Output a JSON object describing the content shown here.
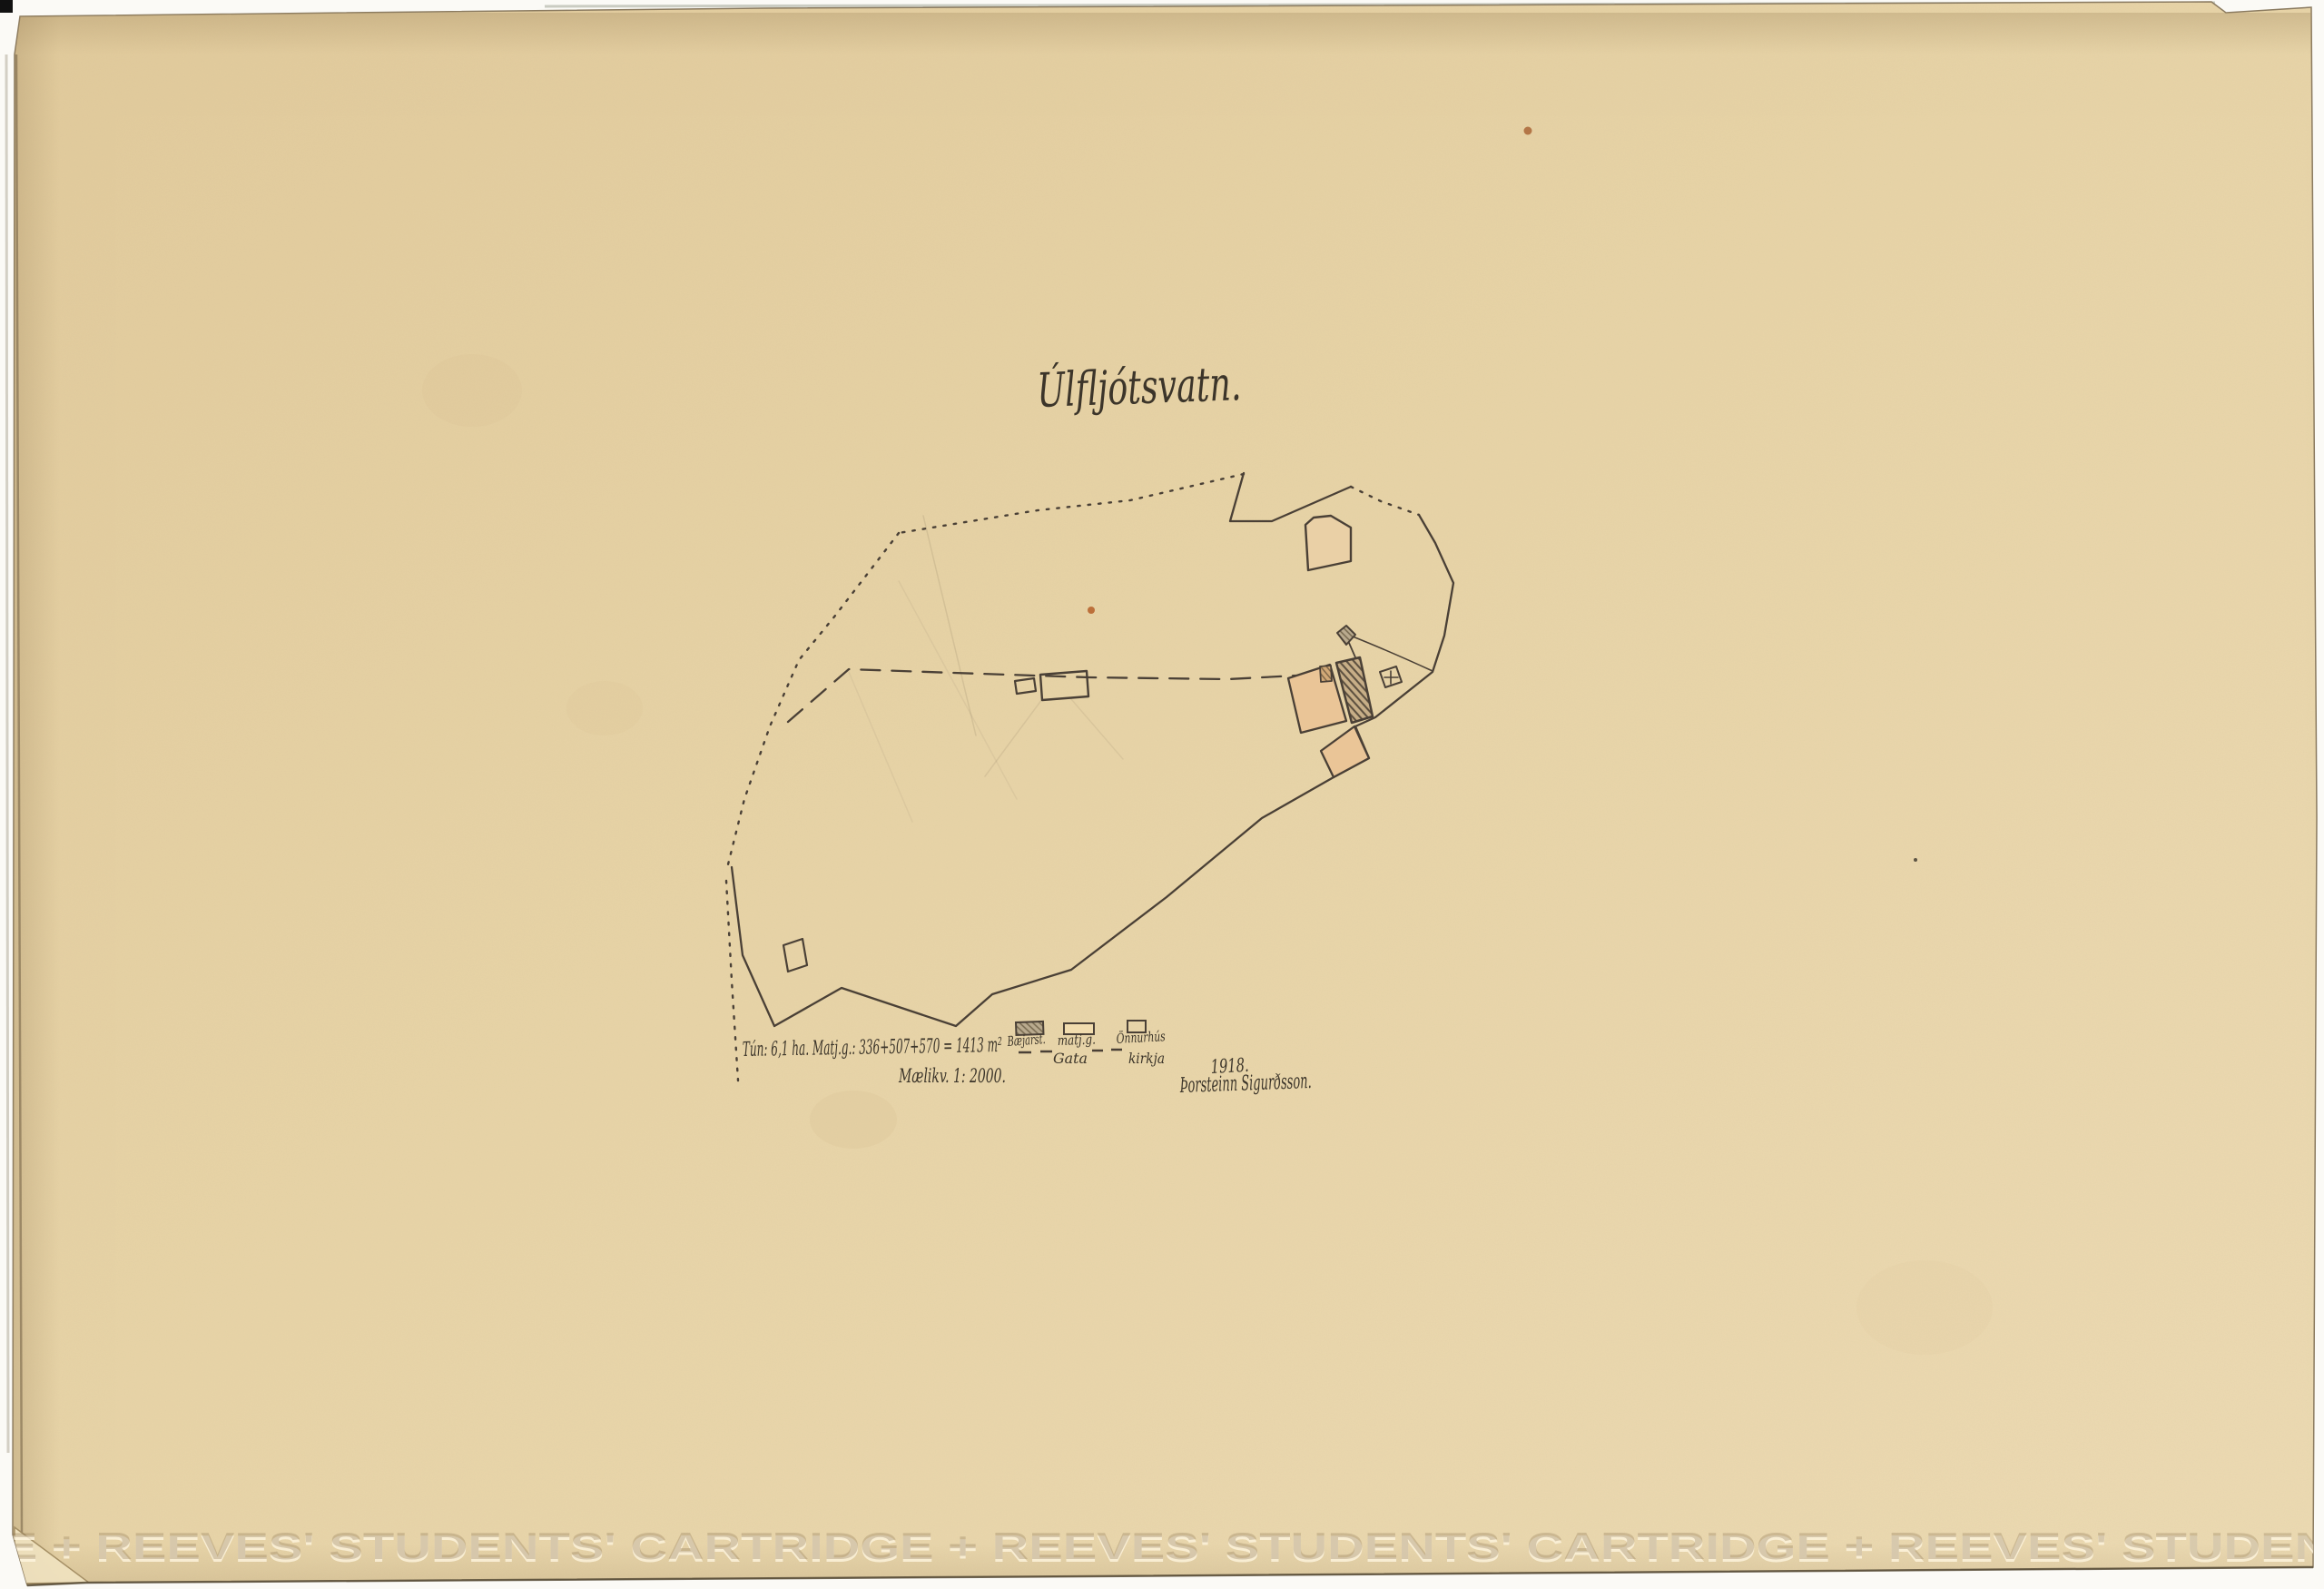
{
  "document": {
    "type": "scanned hand-drawn farm survey map, Iceland, 1918",
    "title": "Úlfljótsvatn.",
    "area_note": "Tún: 6,1 ha. Matj.g.: 336+507+570 = 1413 m²",
    "scale_note": "Mælikv. 1: 2000.",
    "year": "1918.",
    "signature": "Þorsteinn Sigurðsson.",
    "watermark_text": "GE   +   REEVES'  STUDENTS'  CARTRIDGE   +   REEVES'  STUDENTS'  CARTRIDGE   +   REEVES'  STUDENTS"
  },
  "legend": {
    "items": [
      {
        "id": "baejarstaedi",
        "label": "Bæjarst.",
        "swatch": "hatched-gray-box"
      },
      {
        "id": "matjurtagardur",
        "label": "matj.g.",
        "swatch": "orange-filled-box"
      },
      {
        "id": "onnur_hus",
        "label": "Önnurhús",
        "swatch": "outline-box"
      },
      {
        "id": "gata",
        "label": "Gata",
        "swatch": "dashed-line"
      },
      {
        "id": "kirkja",
        "label": "kirkja",
        "swatch": "cross-in-square"
      }
    ]
  },
  "map": {
    "boundary_styles": [
      "solid tún outline",
      "dotted property line",
      "dashed path (gata)"
    ],
    "features": [
      "orange pentagon enclosure (north)",
      "small hatched shed (above farmstead)",
      "orange vegetable garden quad",
      "small hatched annex on garden",
      "large hatched farmstead (bæjarstæði)",
      "church square with cross (kirkja)",
      "orange vegetable garden diamond (south)",
      "two outline other-houses by the path",
      "outline house (south-west)"
    ]
  },
  "colors": {
    "paper": "#e8d4a7",
    "paper_light": "#eedcb4",
    "ink": "#4a4036",
    "orange_fill": "#eac597",
    "orange_pale": "#ead0a6",
    "hatch_brown": "#c7ae87",
    "hatch_gray": "#b5a68b",
    "scan_background": "#ffffff"
  }
}
